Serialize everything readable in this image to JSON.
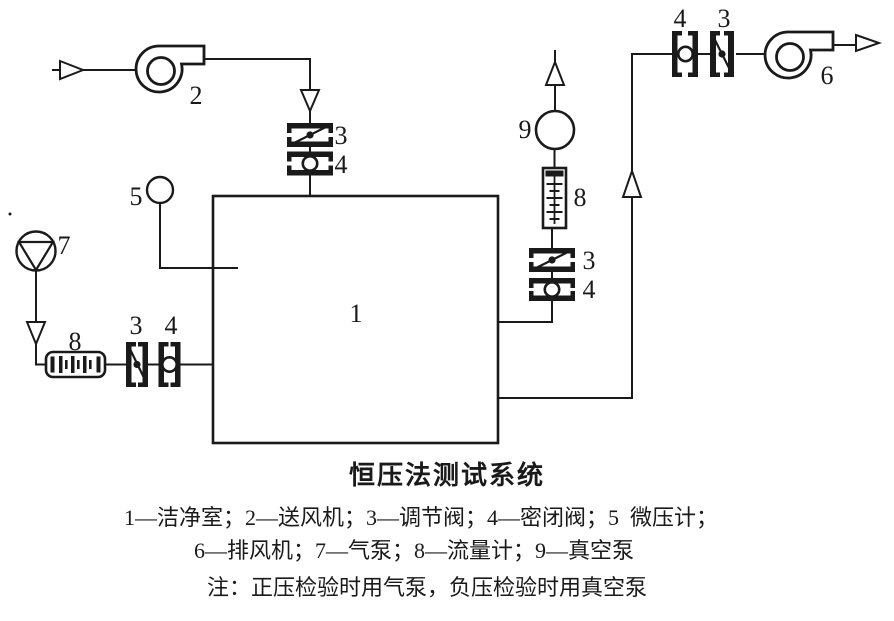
{
  "title": "恒压法测试系统",
  "legend": {
    "line1": "1—洁净室；2—送风机；3—调节阀；4—密闭阀；5  微压计；",
    "line2": "6—排风机；7—气泵；8—流量计；9—真空泵",
    "note": "注：正压检验时用气泵，负压检验时用真空泵"
  },
  "labels": {
    "cleanroom": "1",
    "supply_fan": "2",
    "regulating_valve": "3",
    "sealing_valve": "4",
    "micro_manometer": "5",
    "exhaust_fan": "6",
    "air_pump": "7",
    "flow_meter": "8",
    "vacuum_pump": "9"
  },
  "colors": {
    "ink": "#1a1a1a",
    "background": "#ffffff"
  }
}
